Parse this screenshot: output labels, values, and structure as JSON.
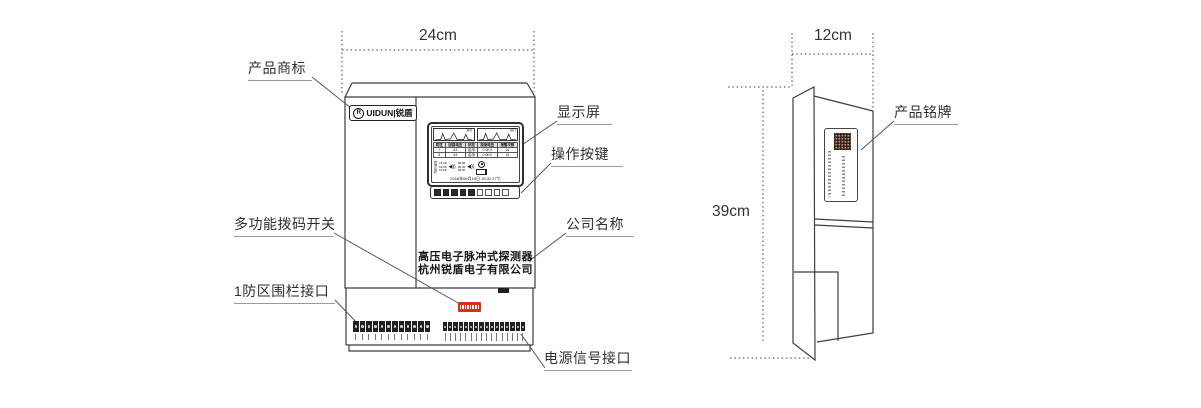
{
  "colors": {
    "line": "#3e3e3e",
    "leader": "#555555",
    "dip_red": "#e02a1c",
    "qr_dark": "#3b2318"
  },
  "callouts": {
    "trademark": "产品商标",
    "display": "显示屏",
    "buttons": "操作按键",
    "dip_switch": "多功能拨码开关",
    "company": "公司名称",
    "fence_port": "1防区围栏接口",
    "power_port": "电源信号接口",
    "nameplate": "产品铭牌"
  },
  "front_view": {
    "width_dim": "24cm",
    "logo": {
      "icon": "R",
      "text": "UIDUN|锐盾"
    },
    "product_name": "高压电子脉冲式探测器",
    "company_name": "杭州锐盾电子有限公司",
    "screen": {
      "chart1_label": "运行",
      "chart2_label": "运行",
      "table_header": [
        "防区",
        "回路电压",
        "状态",
        "探测电压",
        "报警次数"
      ],
      "table_rows": [
        [
          "Ⅰ",
          "63",
          "启用",
          "0.0KV",
          "1s"
        ],
        [
          "Ⅱ",
          "64",
          "启用",
          "0.0KV",
          "15"
        ]
      ],
      "status_labels": [
        "布",
        "撤",
        "旁",
        "状"
      ],
      "times_left": [
        "15:08",
        "18:08",
        "19:08"
      ],
      "times_right": [
        "08:08",
        "08:45",
        "08:00"
      ],
      "speaker_icon": "◀))",
      "datetime": "2016年06月15日 15:32 27℃"
    },
    "counts": {
      "buttons_dark": 5,
      "buttons_light": 4,
      "dip_levers": 8,
      "left_terminals": 12,
      "right_terminals": 16
    }
  },
  "side_view": {
    "width_dim": "12cm",
    "height_dim": "39cm"
  }
}
